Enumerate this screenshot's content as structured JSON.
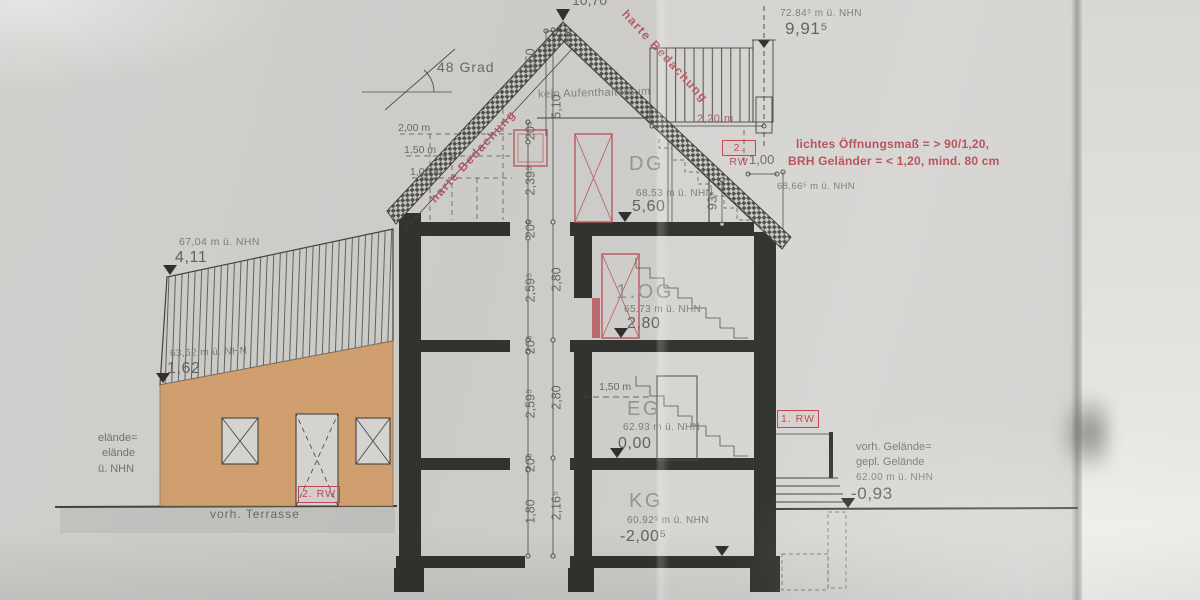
{
  "drawing": {
    "apex_level": "10,70",
    "roof": {
      "angle": "48 Grad",
      "covering_left": "harte Bedachung",
      "covering_right": "harte Bedachung",
      "no_occupancy": "kein Aufenthaltsraum",
      "slope_dim": "2,50",
      "ridge_nhn": "72.84⁵ m ü. NHN",
      "ridge_height": "9,91⁵",
      "line_200": "2,00 m",
      "line_150": "1,50 m",
      "line_100": "1,00 m",
      "railing_width": "2,20 m",
      "rescue_badge": "2. RW",
      "window_width": "1,00",
      "parapet_height": "93⁵",
      "eaves_nhn": "68,66⁵ m ü. NHN",
      "note_line_1": "lichtes Öffnungsmaß = > 90/1,20,",
      "note_line_2": "BRH Geländer = < 1,20, mind. 80 cm"
    },
    "floors": {
      "dg": {
        "label": "DG",
        "nhn": "68.53 m ü. NHN",
        "level": "5,60"
      },
      "og": {
        "label": "1.OG",
        "nhn": "65.73 m ü. NHN",
        "level": "2,80"
      },
      "eg": {
        "label": "EG",
        "nhn": "62.93 m ü. NHN",
        "level": "0,00",
        "door_height": "1,50 m"
      },
      "kg": {
        "label": "KG",
        "nhn": "60.92⁵ m ü. NHN",
        "level": "-2,00⁵"
      }
    },
    "dims": {
      "inner": [
        "20⁵",
        "2,39⁵",
        "20⁵",
        "2,59⁵",
        "20⁵",
        "2,59⁵",
        "20⁵",
        "1,80"
      ],
      "outer": [
        "5,10",
        "2,80",
        "2,80",
        "2,16⁵"
      ]
    },
    "annex": {
      "roof_nhn": "67,04 m ü. NHN",
      "roof_level": "4,11",
      "eaves_nhn": "63,62 m ü. NHN",
      "eaves_level": "1,62",
      "terrace": "vorh. Terrasse",
      "rescue_badge": "2. RW",
      "edge_line_1": "elände=",
      "edge_line_2": "elände",
      "edge_line_3": "ü. NHN"
    },
    "site": {
      "rescue_badge": "1. RW",
      "ground_line_1": "vorh. Gelände=",
      "ground_line_2": "gepl. Gelände",
      "ground_nhn": "62.00 m ü. NHN",
      "ground_level": "-0,93"
    },
    "colors": {
      "annotation_red": "#bb535d",
      "annex_wall_orange": "#d7a473",
      "ink": "#45443f"
    }
  }
}
